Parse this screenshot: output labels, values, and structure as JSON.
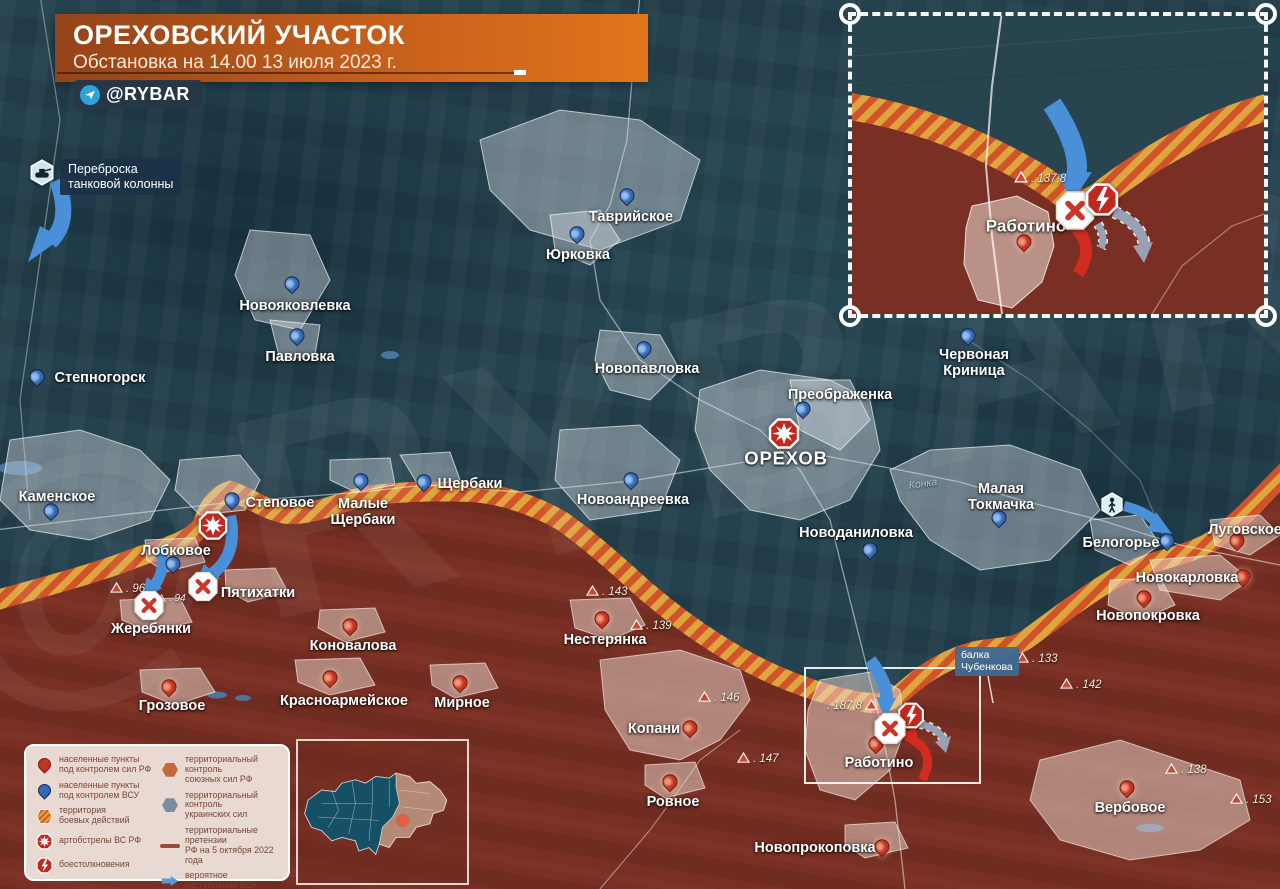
{
  "header": {
    "title": "ОРЕХОВСКИЙ УЧАСТОК",
    "subtitle": "Обстановка на 14.00 13 июля 2023 г.",
    "badge": "@RYBAR"
  },
  "watermark": "@RYBAR",
  "annotations": {
    "tank_transfer": "Переброска\nтанковой колонны",
    "balka": "балка\nЧубенкова",
    "river": "Конка"
  },
  "colors": {
    "ua_area": "#24414e",
    "ru_area": "#7c2e22",
    "front_gold": "#dfa43e",
    "front_red": "#cf5429",
    "arrow_ua_blue": "#4a90d8",
    "arrow_ru_red": "#d22b20",
    "banner_orange": "#c65f1b"
  },
  "towns": [
    {
      "n": "Степногорск",
      "s": "ua",
      "m": "pin",
      "mx": 37,
      "my": 383,
      "lx": 100,
      "ly": 378,
      "big": 0
    },
    {
      "n": "Таврийское",
      "s": "ua",
      "m": "pin",
      "mx": 627,
      "my": 202,
      "lx": 631,
      "ly": 217,
      "big": 0
    },
    {
      "n": "Юрковка",
      "s": "ua",
      "m": "pin",
      "mx": 577,
      "my": 240,
      "lx": 578,
      "ly": 255,
      "big": 0
    },
    {
      "n": "Новояковлевка",
      "s": "ua",
      "m": "pin",
      "mx": 292,
      "my": 290,
      "lx": 295,
      "ly": 306,
      "big": 0
    },
    {
      "n": "Павловка",
      "s": "ua",
      "m": "pin",
      "mx": 297,
      "my": 342,
      "lx": 300,
      "ly": 357,
      "big": 0
    },
    {
      "n": "Новопавловка",
      "s": "ua",
      "m": "pin",
      "mx": 644,
      "my": 355,
      "lx": 647,
      "ly": 369,
      "big": 0
    },
    {
      "n": "Преображенка",
      "s": "ua",
      "m": "pin",
      "mx": 803,
      "my": 415,
      "lx": 840,
      "ly": 395,
      "big": 0
    },
    {
      "n": "ОРЕХОВ",
      "s": "ua",
      "m": "none",
      "mx": 0,
      "my": 0,
      "lx": 786,
      "ly": 459,
      "big": 1
    },
    {
      "n": "Червоная\nКриница",
      "s": "ua",
      "m": "pin",
      "mx": 968,
      "my": 342,
      "lx": 974,
      "ly": 363,
      "big": 0
    },
    {
      "n": "Каменское",
      "s": "ua",
      "m": "pin",
      "mx": 51,
      "my": 517,
      "lx": 57,
      "ly": 497,
      "big": 0
    },
    {
      "n": "Степовое",
      "s": "ua",
      "m": "pin",
      "mx": 232,
      "my": 506,
      "lx": 280,
      "ly": 503,
      "big": 0
    },
    {
      "n": "Малые\nЩербаки",
      "s": "ua",
      "m": "pin",
      "mx": 361,
      "my": 487,
      "lx": 363,
      "ly": 512,
      "big": 0
    },
    {
      "n": "Щербаки",
      "s": "ua",
      "m": "pin",
      "mx": 424,
      "my": 488,
      "lx": 470,
      "ly": 484,
      "big": 0
    },
    {
      "n": "Новоандреевка",
      "s": "ua",
      "m": "pin",
      "mx": 631,
      "my": 486,
      "lx": 633,
      "ly": 500,
      "big": 0
    },
    {
      "n": "Новоданиловка",
      "s": "ua",
      "m": "pin",
      "mx": 870,
      "my": 556,
      "lx": 856,
      "ly": 533,
      "big": 0
    },
    {
      "n": "Малая\nТокмачка",
      "s": "ua",
      "m": "pin",
      "mx": 999,
      "my": 524,
      "lx": 1001,
      "ly": 497,
      "big": 0
    },
    {
      "n": "Белогорье",
      "s": "ua",
      "m": "pin",
      "mx": 1167,
      "my": 547,
      "lx": 1121,
      "ly": 543,
      "big": 0
    },
    {
      "n": "Лобковое",
      "s": "ua",
      "m": "pin",
      "mx": 173,
      "my": 570,
      "lx": 176,
      "ly": 551,
      "big": 0
    },
    {
      "n": "Луговское",
      "s": "ru",
      "m": "pin",
      "mx": 1237,
      "my": 547,
      "lx": 1245,
      "ly": 530,
      "big": 0
    },
    {
      "n": "Новокарловка",
      "s": "ru",
      "m": "pin",
      "mx": 1243,
      "my": 583,
      "lx": 1187,
      "ly": 578,
      "big": 0
    },
    {
      "n": "Новопокровка",
      "s": "ru",
      "m": "pin",
      "mx": 1144,
      "my": 604,
      "lx": 1148,
      "ly": 616,
      "big": 0
    },
    {
      "n": "Пятихатки",
      "s": "ru",
      "m": "none",
      "mx": 0,
      "my": 0,
      "lx": 258,
      "ly": 593,
      "big": 0
    },
    {
      "n": "Жеребянки",
      "s": "ru",
      "m": "none",
      "mx": 0,
      "my": 0,
      "lx": 151,
      "ly": 629,
      "big": 0
    },
    {
      "n": "Коновалова",
      "s": "ru",
      "m": "pin",
      "mx": 350,
      "my": 632,
      "lx": 353,
      "ly": 646,
      "big": 0
    },
    {
      "n": "Грозовое",
      "s": "ru",
      "m": "pin",
      "mx": 169,
      "my": 693,
      "lx": 172,
      "ly": 706,
      "big": 0
    },
    {
      "n": "Красноармейское",
      "s": "ru",
      "m": "pin",
      "mx": 330,
      "my": 684,
      "lx": 344,
      "ly": 701,
      "big": 0
    },
    {
      "n": "Мирное",
      "s": "ru",
      "m": "pin",
      "mx": 460,
      "my": 689,
      "lx": 462,
      "ly": 703,
      "big": 0
    },
    {
      "n": "Нестерянка",
      "s": "ru",
      "m": "pin",
      "mx": 602,
      "my": 625,
      "lx": 605,
      "ly": 640,
      "big": 0
    },
    {
      "n": "Копани",
      "s": "ru",
      "m": "pin",
      "mx": 690,
      "my": 734,
      "lx": 654,
      "ly": 729,
      "big": 0
    },
    {
      "n": "Ровное",
      "s": "ru",
      "m": "pin",
      "mx": 670,
      "my": 788,
      "lx": 673,
      "ly": 802,
      "big": 0
    },
    {
      "n": "Новопрокоповка",
      "s": "ru",
      "m": "pin",
      "mx": 882,
      "my": 853,
      "lx": 815,
      "ly": 848,
      "big": 0
    },
    {
      "n": "Работино",
      "s": "ru",
      "m": "pin",
      "mx": 876,
      "my": 750,
      "lx": 879,
      "ly": 763,
      "big": 0
    },
    {
      "n": "Вербовое",
      "s": "ru",
      "m": "pin",
      "mx": 1127,
      "my": 794,
      "lx": 1130,
      "ly": 808,
      "big": 0
    }
  ],
  "elevations": [
    {
      "v": "96",
      "x": 116,
      "y": 589,
      "side": "right",
      "small": 0
    },
    {
      "v": "94",
      "x": 163,
      "y": 598,
      "side": "right",
      "small": 1
    },
    {
      "v": "143",
      "x": 592,
      "y": 592,
      "side": "right",
      "small": 0
    },
    {
      "v": "139",
      "x": 636,
      "y": 626,
      "side": "right",
      "small": 0
    },
    {
      "v": "146",
      "x": 704,
      "y": 698,
      "side": "right",
      "small": 0
    },
    {
      "v": "147",
      "x": 743,
      "y": 759,
      "side": "right",
      "small": 0
    },
    {
      "v": "133",
      "x": 1022,
      "y": 659,
      "side": "right",
      "small": 0
    },
    {
      "v": "142",
      "x": 1066,
      "y": 685,
      "side": "right",
      "small": 0
    },
    {
      "v": "138",
      "x": 1171,
      "y": 770,
      "side": "right",
      "small": 0
    },
    {
      "v": "153",
      "x": 1236,
      "y": 800,
      "side": "right",
      "small": 0
    },
    {
      "v": "187,8",
      "x": 870,
      "y": 706,
      "side": "left",
      "small": 0
    }
  ],
  "combat_icons": [
    {
      "t": "artillery",
      "x": 213,
      "y": 528,
      "sz": 30
    },
    {
      "t": "artillery",
      "x": 784,
      "y": 436,
      "sz": 32
    },
    {
      "t": "clash",
      "x": 911,
      "y": 718,
      "sz": 27
    },
    {
      "t": "failed",
      "x": 149,
      "y": 608,
      "sz": 32
    },
    {
      "t": "failed",
      "x": 203,
      "y": 589,
      "sz": 32
    },
    {
      "t": "failed",
      "x": 890,
      "y": 731,
      "sz": 34
    }
  ],
  "special_icons": [
    {
      "t": "tank",
      "x": 42,
      "y": 175,
      "sz": 27
    },
    {
      "t": "soldier",
      "x": 1112,
      "y": 507,
      "sz": 25
    }
  ],
  "inset": {
    "town": "Работино",
    "elevation": "137,8"
  },
  "legend": {
    "left": [
      {
        "icon": "pin-ru",
        "label": "населенные пункты\nпод контролем сил РФ"
      },
      {
        "icon": "pin-ua",
        "label": "населенные пункты\nпод контролем ВСУ"
      },
      {
        "icon": "hex-battle",
        "label": "территория\nбоевых действий"
      },
      {
        "icon": "artillery",
        "label": "артобстрелы ВС РФ"
      },
      {
        "icon": "clash",
        "label": "боестолкновения"
      }
    ],
    "right": [
      {
        "icon": "hex-ru",
        "label": "территориальный контроль\nсоюзных сил РФ"
      },
      {
        "icon": "hex-ua",
        "label": "территориальный контроль\nукраинских сил"
      },
      {
        "icon": "claim-line",
        "label": "территориальные претензии\nРФ на 5 октября 2022 года"
      },
      {
        "icon": "arrow-ua",
        "label": "вероятное\nнаступление ВСУ"
      },
      {
        "icon": "failed",
        "label": "сорванное наступление"
      }
    ]
  }
}
